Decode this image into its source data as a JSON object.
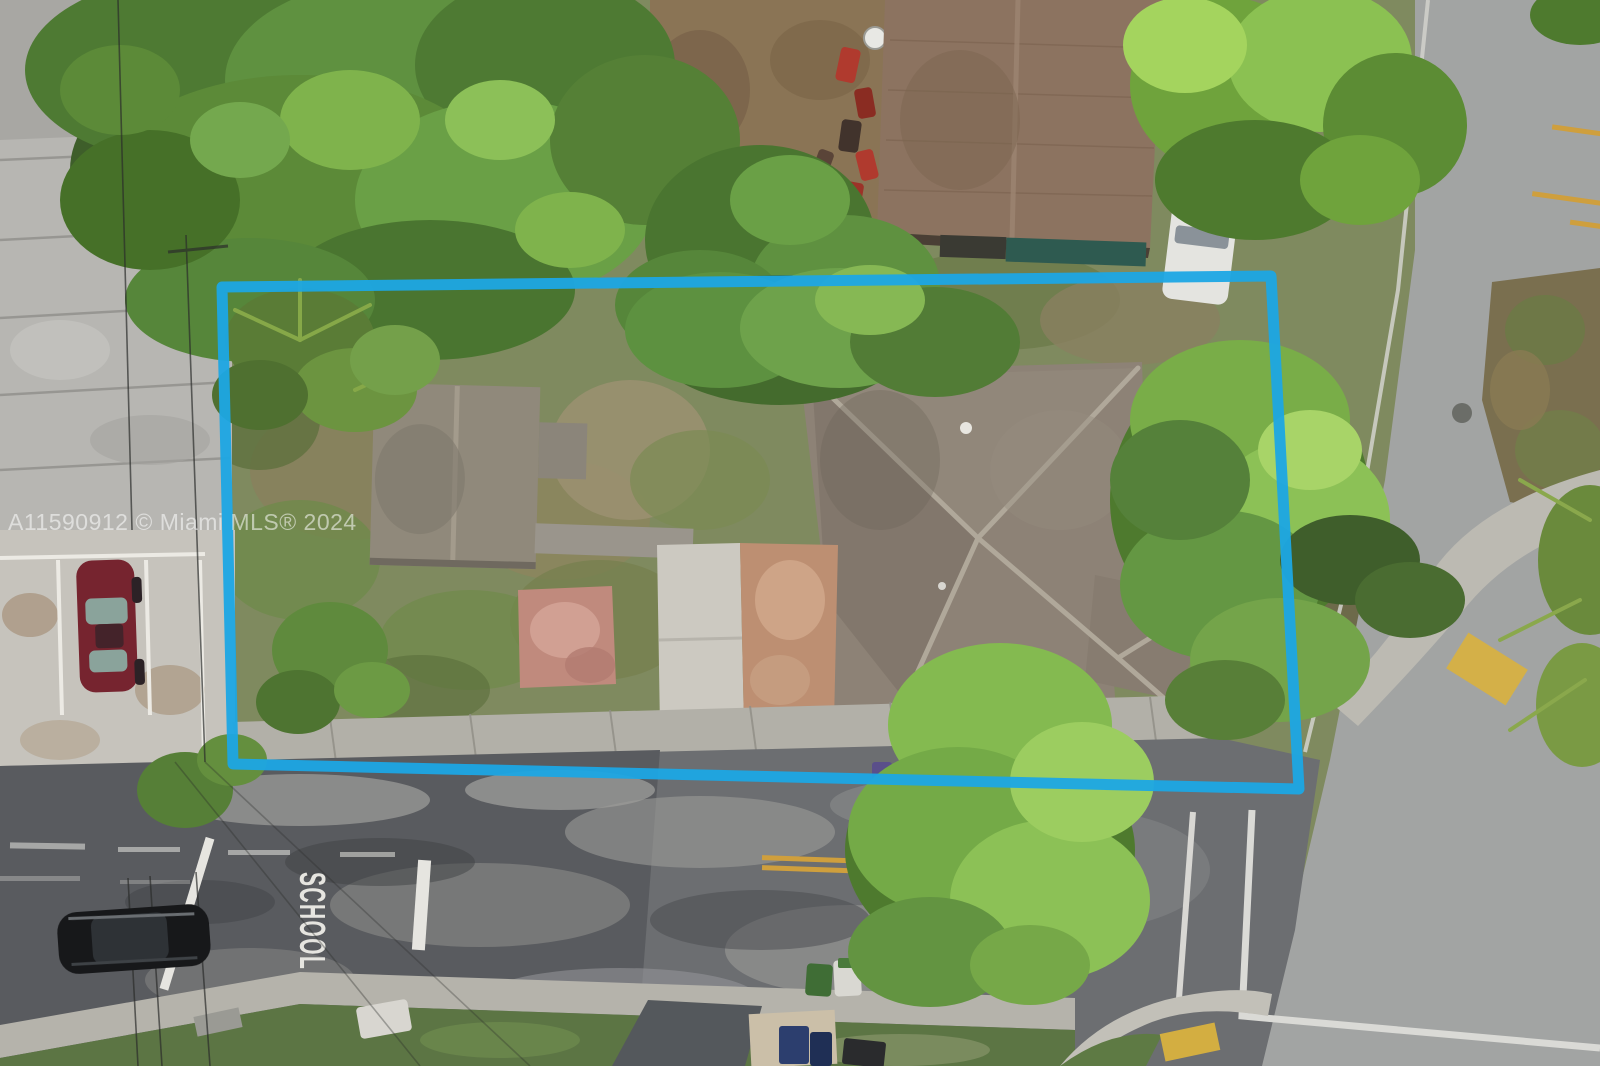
{
  "photo": {
    "watermark_text": "A11590912 © Miami MLS® 2024",
    "school_road_marking": "SCHOOL"
  },
  "palette": {
    "boundary-blue": "#1ca6e4",
    "watermark-white": "rgba(255,255,255,0.55)",
    "road-marking-white": "#e6e5e0",
    "center-line-yellow": "#cf9f3d",
    "main-roof-gray": "#8d8276",
    "neighbor-roof-brown": "#8c7360",
    "small-roof-gray": "#90897b",
    "asphalt-dark": "#595b5f",
    "concrete-light": "#b5b3ab",
    "scrub-ground": "#7f8a5f",
    "grass-green": "#5f7a43",
    "canopy-dark": "#3e5e2a",
    "canopy-mid": "#5c8a38",
    "canopy-light": "#7fb34c",
    "canopy-bright": "#a6d35f",
    "red-car": "#76242f",
    "black-car": "#17181a",
    "pink-pad": "#c08a7d",
    "salmon-driveway": "#bd8f72"
  }
}
